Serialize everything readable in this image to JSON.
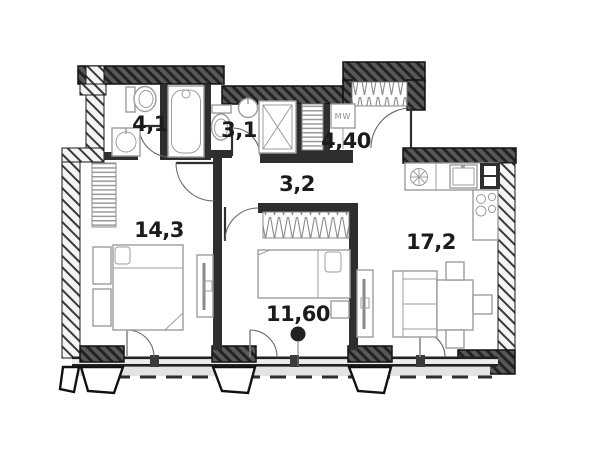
{
  "plan": {
    "type": "apartment-floor-plan",
    "rooms": [
      {
        "id": "wc",
        "area_label": "4,1"
      },
      {
        "id": "bathroom",
        "area_label": "3,1"
      },
      {
        "id": "hallway",
        "area_label": "3,2"
      },
      {
        "id": "entry-hall",
        "area_label": "4,40"
      },
      {
        "id": "bedroom-left",
        "area_label": "14,3"
      },
      {
        "id": "bedroom-middle",
        "area_label": "11,60"
      },
      {
        "id": "living-kitchen",
        "area_label": "17,2"
      }
    ],
    "appliance_labels": {
      "washer": "MW"
    },
    "colors": {
      "wall_dark_fill": "#585858",
      "wall_hatch": "#222222",
      "wall_interior": "#2e2e2e",
      "wall_light_fill": "#f4f4f4",
      "furniture_line": "#9c9c9c",
      "label_text": "#1b1b1b",
      "balcony_strip": "#e3e3e3",
      "window_glazing": "#ececec"
    }
  }
}
